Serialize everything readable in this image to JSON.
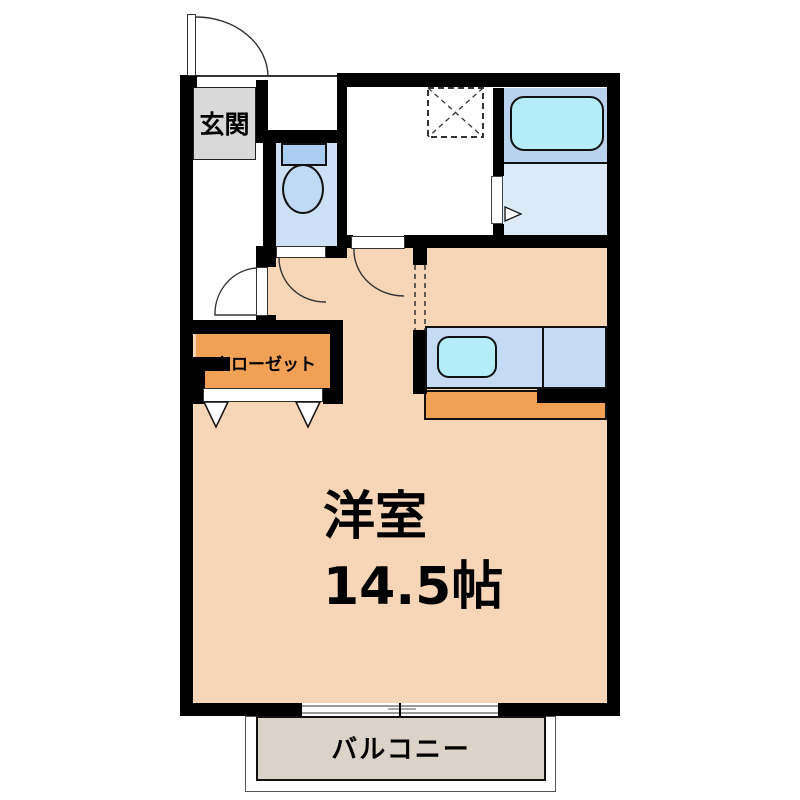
{
  "plan": {
    "type": "apartment-floor-plan",
    "labels": {
      "entrance": "玄関",
      "closet": "クローゼット",
      "main_room_name": "洋室",
      "main_room_size": "14.5帖",
      "balcony": "バルコニー"
    },
    "colors": {
      "wall": "#000000",
      "room_floor": "#f6d6b6",
      "kitchen_closet_floor": "#f0a156",
      "entrance_floor": "#d9d9d9",
      "toilet_floor": "#cde1f6",
      "bath_floor_upper": "#b9d3ee",
      "bath_floor_lower": "#dceaf8",
      "counter": "#c5daf3",
      "tub_and_sink": "#b4ecf7",
      "balcony_floor": "#dbd2c8"
    },
    "fixtures": [
      "entrance-door",
      "hall-door",
      "toilet",
      "toilet-door",
      "washing-machine-space",
      "washroom-door",
      "bathtub",
      "bath-folding-door",
      "kitchen-counter",
      "kitchen-sink",
      "closet-folding-doors",
      "sliding-window"
    ]
  }
}
